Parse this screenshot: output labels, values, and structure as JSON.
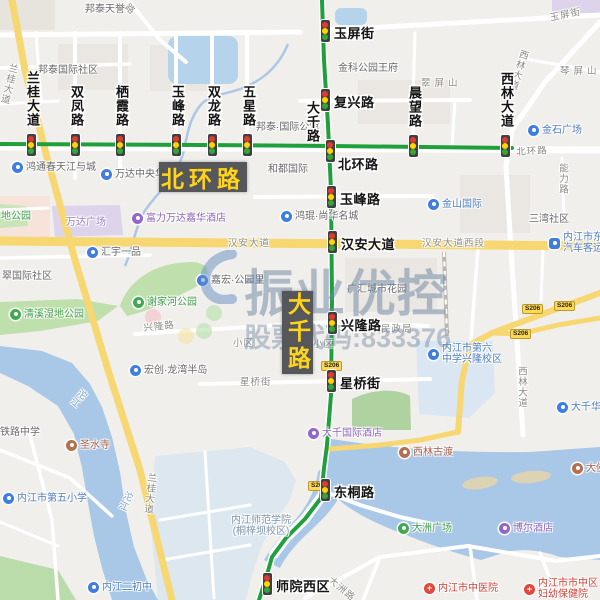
{
  "watermark": {
    "brand": "振业优控",
    "ticker_label": "股票代码:833376"
  },
  "route_badges": [
    {
      "id": "beihuanlu",
      "label": "北环路"
    },
    {
      "id": "daqianlu",
      "label": "大千路"
    }
  ],
  "road_shield_label": "S206",
  "shields": [
    {
      "x": 531,
      "y": 309
    },
    {
      "x": 563,
      "y": 306
    },
    {
      "x": 519,
      "y": 334
    },
    {
      "x": 330,
      "y": 366
    },
    {
      "x": 317,
      "y": 486
    }
  ],
  "road_name_vertical": {
    "label": "大千路",
    "x": 303,
    "y": 101
  },
  "signals": [
    {
      "id": "yupingjie",
      "label": "玉屏街",
      "x": 325,
      "y": 31,
      "side": "right"
    },
    {
      "id": "languidadao",
      "label": "兰桂大道",
      "x": 31,
      "y": 145,
      "side": "above"
    },
    {
      "id": "shuangfenglu",
      "label": "双凤路",
      "x": 75,
      "y": 145,
      "side": "above"
    },
    {
      "id": "qixialu",
      "label": "栖霞路",
      "x": 120,
      "y": 145,
      "side": "above"
    },
    {
      "id": "yufenglu-n",
      "label": "玉峰路",
      "x": 176,
      "y": 145,
      "side": "above"
    },
    {
      "id": "shuanglonglu",
      "label": "双龙路",
      "x": 212,
      "y": 145,
      "side": "above"
    },
    {
      "id": "wuxinglu",
      "label": "五星路",
      "x": 247,
      "y": 145,
      "side": "above"
    },
    {
      "id": "fuxinglu",
      "label": "复兴路",
      "x": 325,
      "y": 100,
      "side": "right"
    },
    {
      "id": "beihuanlu",
      "label": "北环路",
      "x": 330,
      "y": 151,
      "side": "below-right"
    },
    {
      "id": "chenwanglu",
      "label": "晨望路",
      "x": 413,
      "y": 146,
      "side": "above"
    },
    {
      "id": "xilindadao",
      "label": "西林大道",
      "x": 505,
      "y": 146,
      "side": "above"
    },
    {
      "id": "yufenglu-s",
      "label": "玉峰路",
      "x": 331,
      "y": 197,
      "side": "right"
    },
    {
      "id": "hanandadao",
      "label": "汉安大道",
      "x": 332,
      "y": 242,
      "side": "right"
    },
    {
      "id": "xinglonglu",
      "label": "兴隆路",
      "x": 332,
      "y": 323,
      "side": "right"
    },
    {
      "id": "xingqiaojie",
      "label": "星桥街",
      "x": 331,
      "y": 381,
      "side": "right"
    },
    {
      "id": "dongtonglu",
      "label": "东桐路",
      "x": 325,
      "y": 490,
      "side": "right"
    },
    {
      "id": "shiyuanxiqu",
      "label": "师院西区",
      "x": 267,
      "y": 584,
      "side": "right"
    }
  ],
  "street_labels": [
    {
      "text": "玉屏街",
      "x": 549,
      "y": 13,
      "rot": -12
    },
    {
      "text": "北环路",
      "x": 516,
      "y": 147,
      "rot": -3
    },
    {
      "text": "汉安大道",
      "x": 228,
      "y": 238
    },
    {
      "text": "汉安大道西段",
      "x": 422,
      "y": 238
    },
    {
      "text": "兴隆路",
      "x": 143,
      "y": 323,
      "rot": -6
    },
    {
      "text": "星桥街",
      "x": 240,
      "y": 377
    },
    {
      "text": "民政局",
      "x": 381,
      "y": 324
    },
    {
      "text": "小区",
      "x": 233,
      "y": 338
    },
    {
      "text": "小区",
      "x": 313,
      "y": 339
    },
    {
      "text": "能力路",
      "x": 557,
      "y": 163,
      "vert": true
    },
    {
      "text": "西林大道",
      "x": 516,
      "y": 366,
      "vert": true
    },
    {
      "text": "西林大道",
      "x": 519,
      "y": 48,
      "vert": true,
      "rot": 18
    },
    {
      "text": "大洲路",
      "x": 333,
      "y": 575,
      "rot": 40
    },
    {
      "text": "兰桂大道",
      "x": 8,
      "y": 62,
      "vert": true,
      "rot": 14
    },
    {
      "text": "兰桂大道",
      "x": 146,
      "y": 472,
      "vert": true,
      "rot": 6
    },
    {
      "text": "沱江",
      "x": 80,
      "y": 386,
      "vert": true,
      "rot": 40,
      "blue": true
    },
    {
      "text": "沱江",
      "x": 124,
      "y": 489,
      "vert": true,
      "rot": 25,
      "blue": true
    },
    {
      "text": "路",
      "x": 130,
      "y": 2,
      "rot": 45
    },
    {
      "text": "翠屏山",
      "x": 421,
      "y": 78,
      "spread": true
    },
    {
      "text": "琴屏山",
      "x": 560,
      "y": 66,
      "spread": true
    }
  ],
  "pois": [
    {
      "text": "邦泰天誉",
      "x": 85,
      "y": 9,
      "c": "gray"
    },
    {
      "text": "邦泰国际社区",
      "x": 38,
      "y": 70,
      "c": "gray"
    },
    {
      "text": "金科公园王府",
      "x": 338,
      "y": 68,
      "c": "gray"
    },
    {
      "text": "邦泰·国际公馆",
      "x": 256,
      "y": 127,
      "c": "gray"
    },
    {
      "text": "金石广场",
      "icon": "shop",
      "x": 528,
      "y": 130,
      "c": "blue"
    },
    {
      "text": "鸿通春天江与城",
      "icon": "res",
      "x": 12,
      "y": 167,
      "c": "gray"
    },
    {
      "text": "万达中央华城",
      "icon": "res",
      "x": 101,
      "y": 174,
      "c": "gray"
    },
    {
      "text": "和都国际",
      "x": 268,
      "y": 169,
      "c": "gray"
    },
    {
      "text": "金山国际",
      "icon": "shop",
      "x": 428,
      "y": 204,
      "c": "blue"
    },
    {
      "text": "三湾社区",
      "x": 529,
      "y": 219,
      "c": "gray"
    },
    {
      "lines": [
        "内江市东兴",
        "汽车客运站"
      ],
      "icon": "bus",
      "x": 549,
      "y": 243,
      "c": "blue"
    },
    {
      "text": "富力万达嘉华酒店",
      "icon": "hotel",
      "x": 132,
      "y": 218,
      "c": "purple"
    },
    {
      "text": "鸿琨·尚华名城",
      "icon": "res",
      "x": 281,
      "y": 216,
      "c": "gray"
    },
    {
      "text": "万达广场",
      "x": 66,
      "y": 222,
      "c": "purpleplain"
    },
    {
      "text": "汇宇一品",
      "icon": "res",
      "x": 87,
      "y": 252,
      "c": "gray"
    },
    {
      "text": "翠国际社区",
      "x": 2,
      "y": 276,
      "c": "gray"
    },
    {
      "text": "嘉宏·公园里",
      "icon": "res",
      "x": 197,
      "y": 280,
      "c": "gray"
    },
    {
      "text": "谢家河公园",
      "icon": "park",
      "x": 133,
      "y": 302,
      "c": "green"
    },
    {
      "text": "清溪湿地公园",
      "icon": "park",
      "x": 10,
      "y": 314,
      "c": "green"
    },
    {
      "text": "地公园",
      "x": 1,
      "y": 216,
      "c": "green"
    },
    {
      "text": "广汇城市花园",
      "x": 347,
      "y": 289,
      "c": "gray"
    },
    {
      "text": "宏创·龙湾半岛",
      "icon": "res",
      "x": 130,
      "y": 370,
      "c": "gray"
    },
    {
      "lines": [
        "内江市第六",
        "中学兴隆校区"
      ],
      "icon": "school",
      "x": 428,
      "y": 354,
      "c": "blue"
    },
    {
      "text": "大千华庭",
      "icon": "res",
      "x": 557,
      "y": 407,
      "c": "blue"
    },
    {
      "text": "大千国际酒店",
      "icon": "hotel",
      "x": 308,
      "y": 433,
      "c": "purple"
    },
    {
      "text": "圣水寺",
      "icon": "temple",
      "x": 66,
      "y": 445,
      "c": "brown"
    },
    {
      "text": "西林古渡",
      "icon": "temple",
      "x": 399,
      "y": 452,
      "c": "brown"
    },
    {
      "text": "大佛寺",
      "icon": "temple",
      "x": 572,
      "y": 468,
      "c": "brown"
    },
    {
      "text": "内江市第五小学",
      "icon": "school",
      "x": 3,
      "y": 498,
      "c": "blue"
    },
    {
      "text": "铁路中学",
      "x": 0,
      "y": 432,
      "c": "gray"
    },
    {
      "lines": [
        "内江师范学院",
        "(桐梓坝校区)"
      ],
      "x": 231,
      "y": 526,
      "c": "campus",
      "center": true
    },
    {
      "text": "大洲广场",
      "icon": "park",
      "x": 398,
      "y": 528,
      "c": "green"
    },
    {
      "text": "博尔酒店",
      "icon": "hotel",
      "x": 499,
      "y": 528,
      "c": "purple"
    },
    {
      "text": "内江二初中",
      "icon": "school",
      "x": 88,
      "y": 587,
      "c": "blue"
    },
    {
      "text": "内江市中医院",
      "icon": "hosp",
      "x": 424,
      "y": 588,
      "c": "red"
    },
    {
      "lines": [
        "内江市市中区",
        "妇幼保健院"
      ],
      "icon": "hosp",
      "x": 524,
      "y": 589,
      "c": "red"
    }
  ],
  "decor_dots": [
    {
      "x": 153,
      "y": 317,
      "c": "#f5bec6"
    },
    {
      "x": 186,
      "y": 336,
      "c": "#f6e3a0"
    },
    {
      "x": 204,
      "y": 331,
      "c": "#b4dfa8"
    },
    {
      "x": 214,
      "y": 313,
      "c": "#b4dfa8"
    }
  ],
  "colors": {
    "route_green": "#1fa03c",
    "road_yellow": "#f6d772",
    "water": "#a9c7e6",
    "signal_red": "#e23b2e",
    "signal_yellow": "#ffd400",
    "signal_green": "#34a537",
    "badge_bg": "#56575a",
    "badge_text": "#ffd41a",
    "gray": "#696969",
    "blue": "#4f7ec2",
    "purple": "#8d66bb",
    "green": "#3f9d4b",
    "brown": "#a5604b",
    "red": "#d2423a",
    "campus": "#7d94ac",
    "purpleplain": "#9a7fc0"
  }
}
